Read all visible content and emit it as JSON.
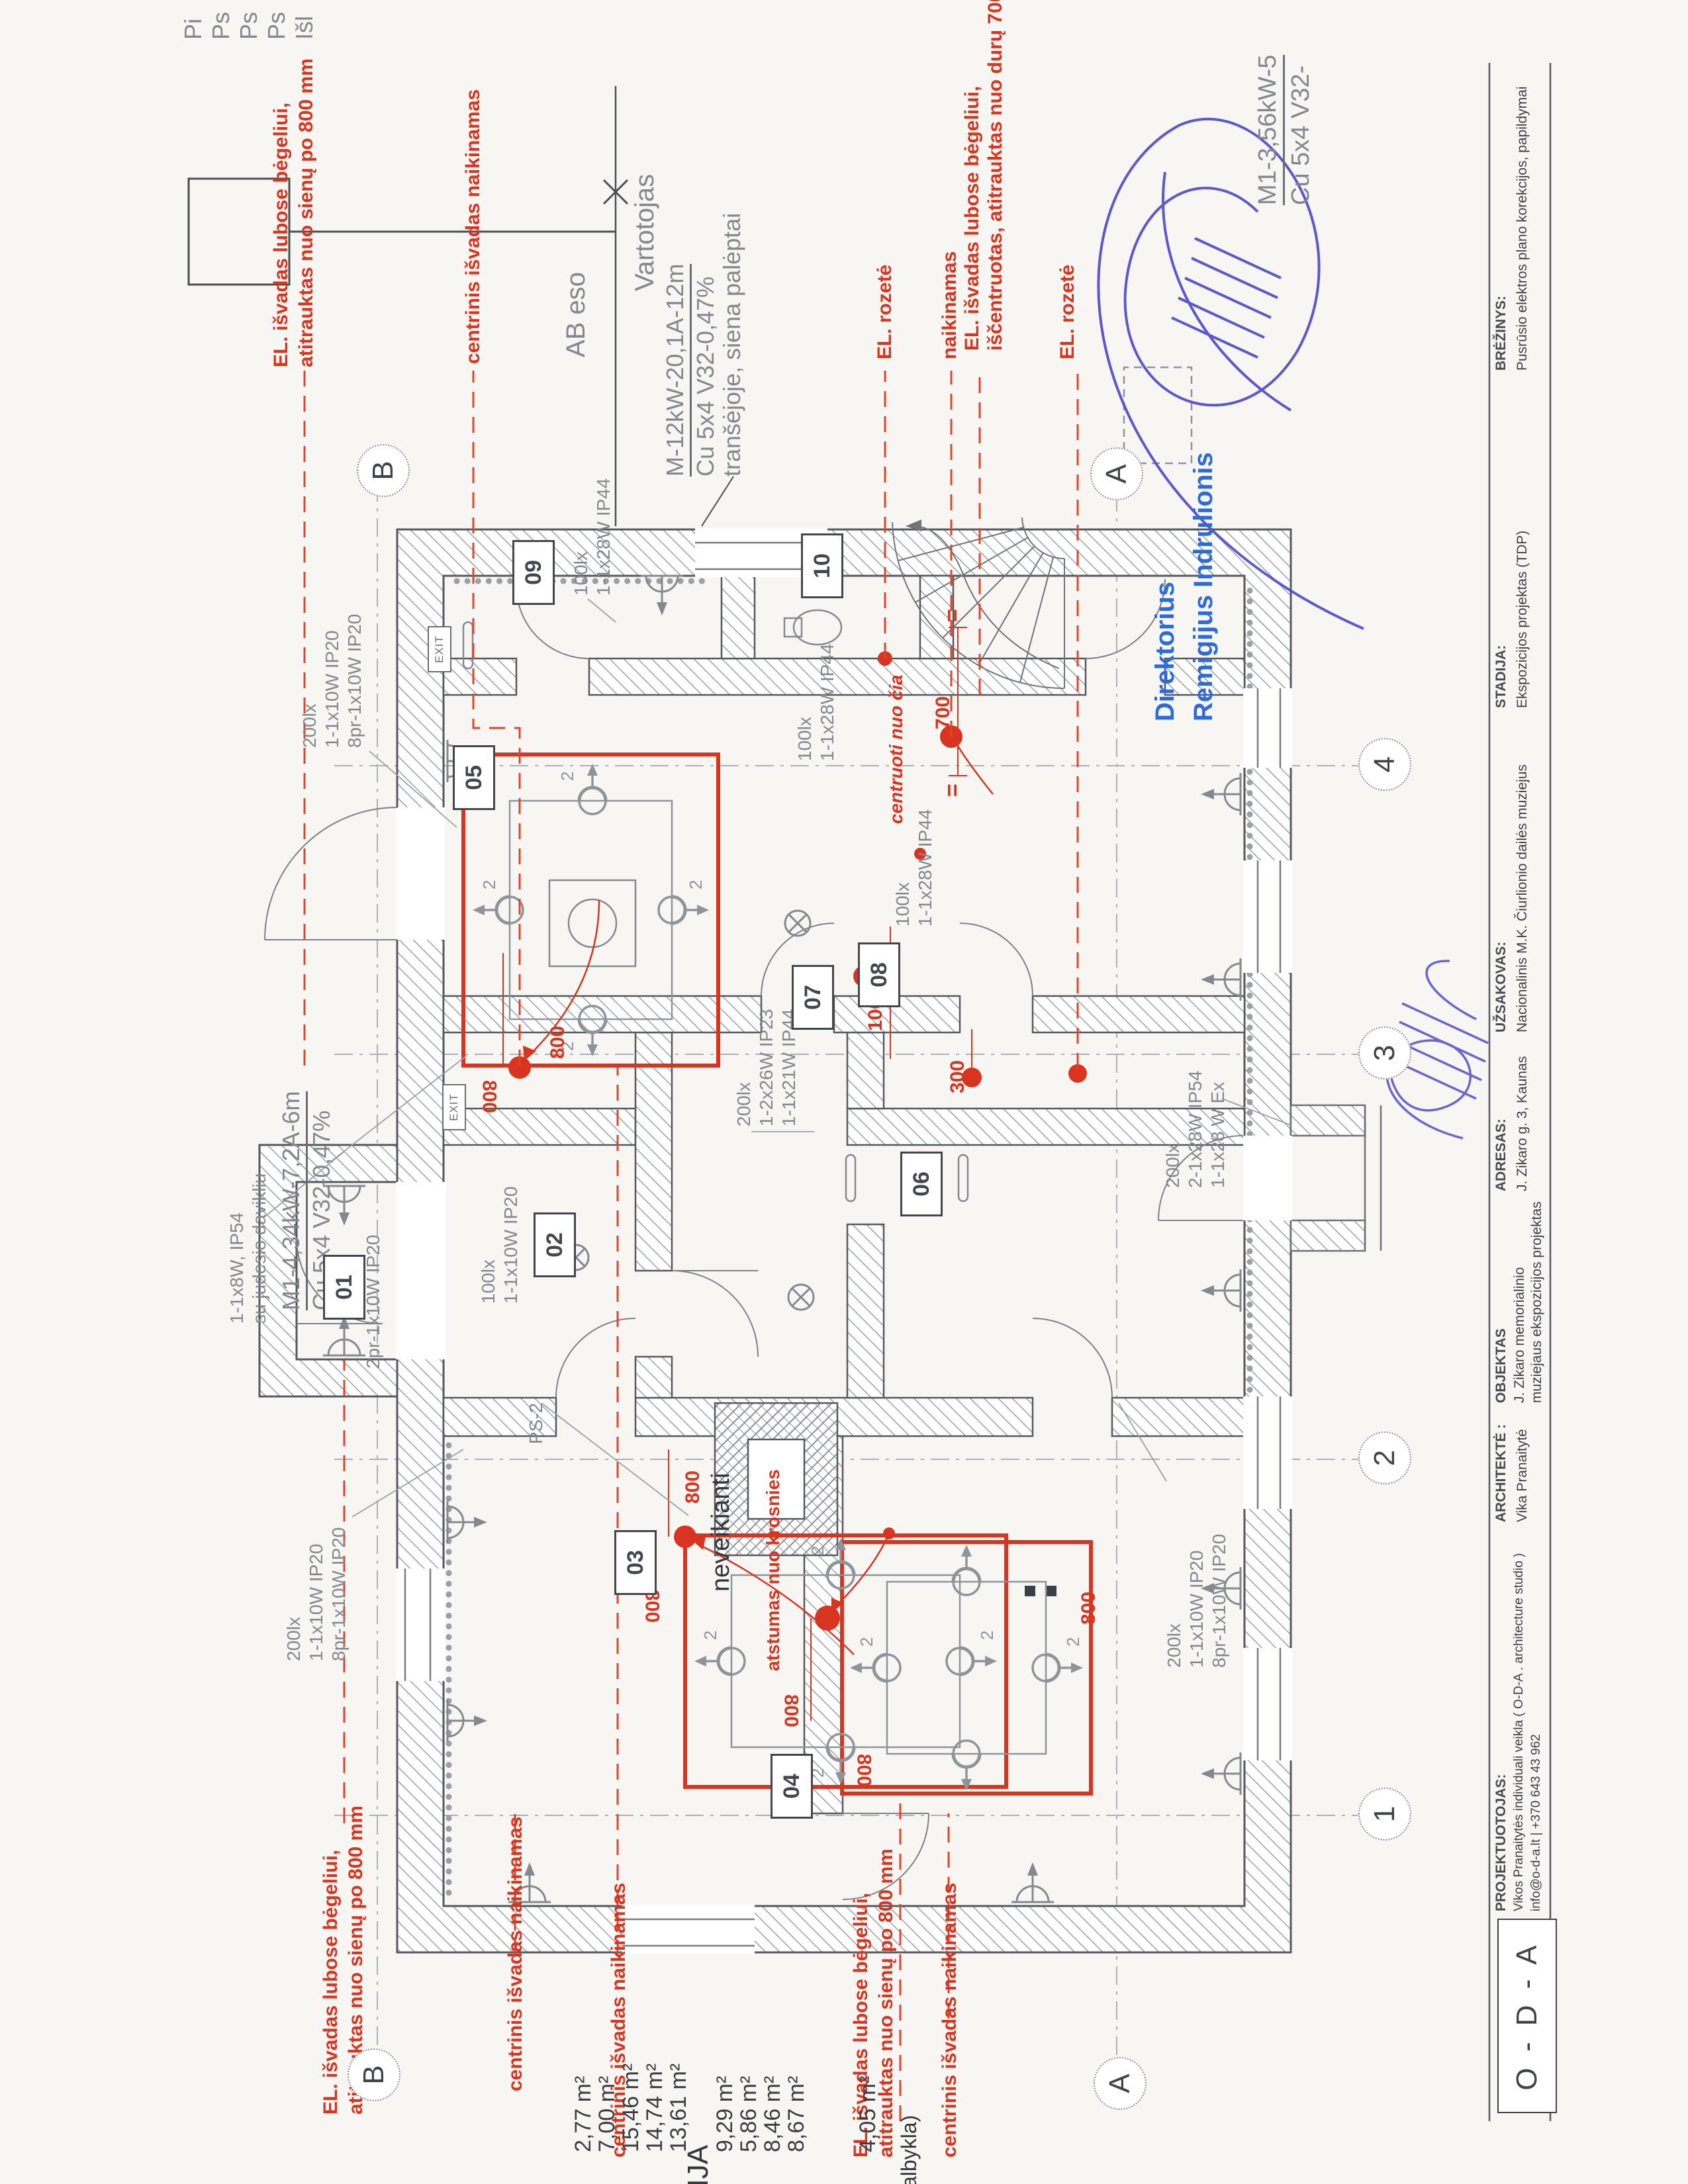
{
  "legend_cut": [
    "Pi",
    "Ps",
    "Ps",
    "Ps",
    "Išl"
  ],
  "utility": {
    "ab": "AB eso",
    "user": "Vartotojas",
    "feeder1": "M-12kW-20,1A-12m",
    "feeder2": "Cu 5x4 V32-0,47%",
    "feeder3": "tranšėjoje, siena palėptai"
  },
  "feeder_m1": {
    "l1": "M1-4,34kW-7,2A-6m",
    "l2": "Cu 5x4 V32-0,47%"
  },
  "feeder_m2": {
    "l1": "M1-3,56kW-5",
    "l2": "Cu 5x4 V32-"
  },
  "stamp": {
    "role": "Direktorius",
    "name": "Remigijus Indrulionis"
  },
  "red_notes": {
    "rail1a": "EL. išvadas lubose bėgeliui,",
    "rail1b": "atitrauktas nuo sienų po 800 mm",
    "central": "centrinis išvadas naikinamas",
    "rozete": "EL. rozetė",
    "naikinamas": "naikinamas",
    "rail2a": "EL. išvadas lubose bėgeliui,",
    "rail2b": "iščentruotas, atitrauktas nuo durų 700 mm",
    "centruoti": "centruoti nuo čia",
    "atstumas": "atstumas nuo krosnies"
  },
  "labels": {
    "l200": "200lx",
    "l110": "1-1x10W IP20",
    "l8pr": "8pr-1x10W IP20",
    "l100": "100lx",
    "l28ip44": "1-1x28W IP44",
    "lcorr1": "1-2x26W IP23",
    "lcorr2": "1-1x21W IP44",
    "lex1": "2-1x28W IP54",
    "lex2": "1-1x28 W Ex",
    "mot1": "1-1x8W, IP54",
    "mot2": "su judesio davikliu",
    "l2pr": "2pr-1x10W IP20",
    "ps2": "PS-2",
    "neveikianti": "neveikianti"
  },
  "dims": {
    "d800": "800",
    "d700": "700",
    "d1000": "1000",
    "d300": "300",
    "eq": "="
  },
  "marks": {
    "spot": "2",
    "exit": "EXIT"
  },
  "rooms": {
    "r01": "01",
    "r02": "02",
    "r03": "03",
    "r04": "04",
    "r05": "05",
    "r06": "06",
    "r07": "07",
    "r08": "08",
    "r09": "09",
    "r10": "10"
  },
  "grid": {
    "a": "A",
    "b": "B",
    "n1": "1",
    "n2": "2",
    "n3": "3",
    "n4": "4"
  },
  "areas": {
    "title_cut": "KACIJA",
    "rows": [
      "2,77 m²",
      "7,00 m²",
      "15,46 m²",
      "14,74 m²",
      "13,61 m²",
      "9,29 m²",
      "5,86 m²",
      "8,46 m²",
      "8,67 m²",
      "4,05 m²"
    ],
    "name_cut": "albykla)"
  },
  "title_block": {
    "logo": "O - D - A",
    "f1_label": "PROJEKTUOTOJAS:",
    "f1_v1": "Vikos Pranaitytės individuali veikla ( O-D-A . architecture studio )",
    "f1_v2": "info@o-d-a.lt  |  +370 643 43 962",
    "f2_label": "ARCHITEKTĖ :",
    "f2_v": "Vika Pranaitytė",
    "f3_label": "OBJEKTAS",
    "f3_v1": "J. Zikaro memorialinio",
    "f3_v2": "muziejaus ekspozicijos projektas",
    "f4_label": "ADRESAS:",
    "f4_v": "J. Zikaro g. 3, Kaunas",
    "f5_label": "UŽSAKOVAS:",
    "f5_v": "Nacionalinis M.K. Čiurlionio dailės muziejus",
    "f6_label": "STADIJA:",
    "f6_v": "Ekspozicijos projektas (TDP)",
    "f7_label": "BRĖŽINYS:",
    "f7_v": "Pusrūsio elektros plano korekcijos, papildymai"
  }
}
